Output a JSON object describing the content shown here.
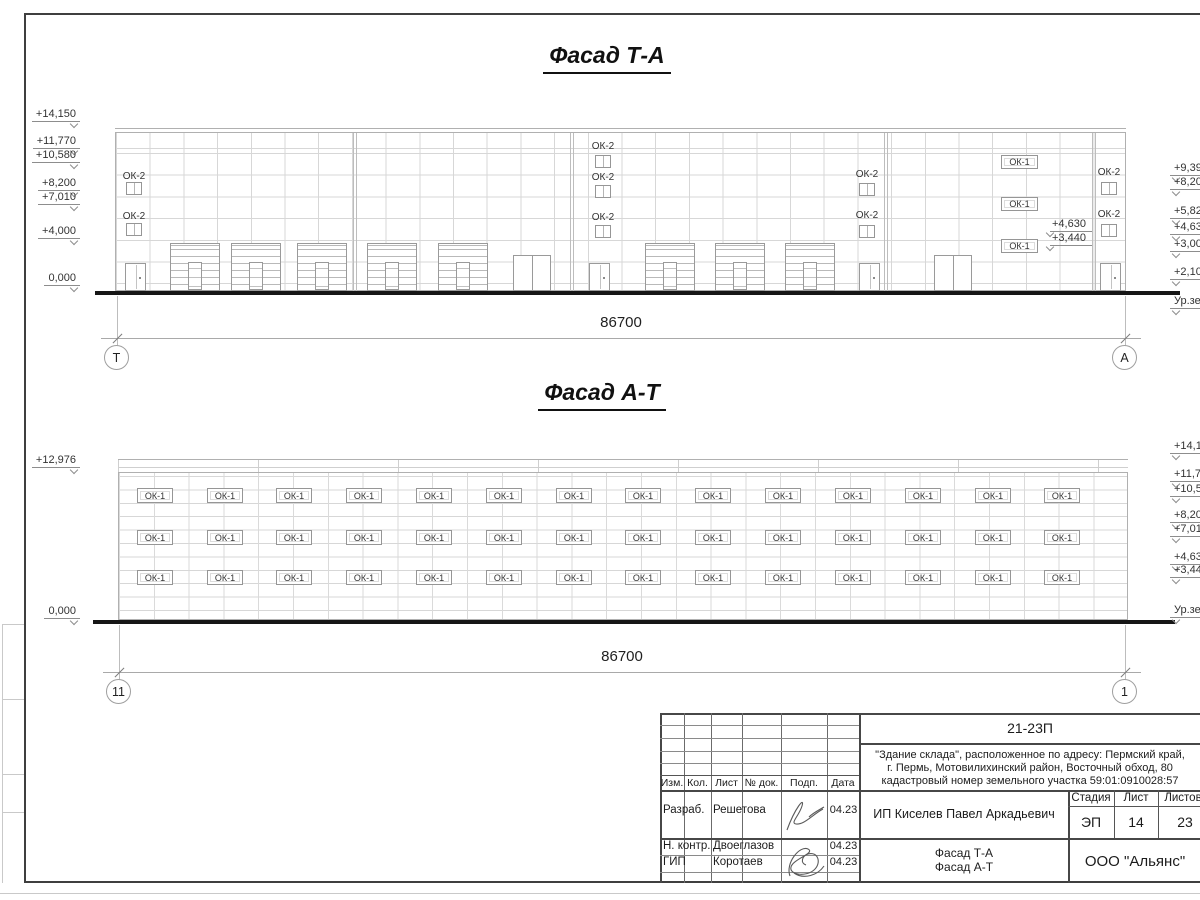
{
  "facade1": {
    "title": "Фасад Т-А",
    "dimension": "86700",
    "axis_left": "Т",
    "axis_right": "А",
    "ok2_label": "ОК-2",
    "ok1_label": "ОК-1",
    "left_marks": [
      {
        "t": "+14,150",
        "y": 115
      },
      {
        "t": "+11,770",
        "y": 142
      },
      {
        "t": "+10,580",
        "y": 156
      },
      {
        "t": "+8,200",
        "y": 184
      },
      {
        "t": "+7,010",
        "y": 198
      },
      {
        "t": "+4,000",
        "y": 232
      },
      {
        "t": "0,000",
        "y": 279
      }
    ],
    "right_marks": [
      {
        "t": "+9,39",
        "y": 169
      },
      {
        "t": "+8,20",
        "y": 183
      },
      {
        "t": "+5,82",
        "y": 212
      },
      {
        "t": "+4,63",
        "y": 228
      },
      {
        "t": "+3,000",
        "y": 245
      },
      {
        "t": "+2,10",
        "y": 273
      },
      {
        "t": "Ур.зе",
        "y": 302
      }
    ],
    "ok2_windows": [
      {
        "x": 126,
        "label_y": 177,
        "win_y": 182
      },
      {
        "x": 126,
        "label_y": 217,
        "win_y": 223
      },
      {
        "x": 595,
        "label_y": 147,
        "win_y": 155
      },
      {
        "x": 595,
        "label_y": 178,
        "win_y": 185
      },
      {
        "x": 595,
        "label_y": 218,
        "win_y": 225
      },
      {
        "x": 859,
        "label_y": 175,
        "win_y": 183
      },
      {
        "x": 859,
        "label_y": 216,
        "win_y": 225
      },
      {
        "x": 1101,
        "label_y": 173,
        "win_y": 182
      },
      {
        "x": 1101,
        "label_y": 215,
        "win_y": 224
      }
    ],
    "ok1_windows": [
      {
        "x": 1001,
        "y": 155
      },
      {
        "x": 1001,
        "y": 197
      },
      {
        "x": 1001,
        "y": 239
      }
    ],
    "annotations": [
      {
        "t": "+4,630",
        "x": 1050,
        "y": 218
      },
      {
        "t": "+3,440",
        "x": 1050,
        "y": 232
      }
    ],
    "doors": [
      125,
      589,
      859,
      1100
    ],
    "double_doors": [
      513,
      934
    ],
    "garage_doors": [
      170,
      231,
      297,
      367,
      438,
      645,
      715,
      785
    ]
  },
  "facade2": {
    "title": "Фасад А-Т",
    "dimension": "86700",
    "axis_left": "11",
    "axis_right": "1",
    "window_label": "ОК-1",
    "window_rows": [
      488,
      530,
      570
    ],
    "window_cols": [
      137,
      207,
      276,
      346,
      416,
      486,
      556,
      625,
      695,
      765,
      835,
      905,
      975,
      1044
    ],
    "left_marks": [
      {
        "t": "+12,976",
        "y": 461
      },
      {
        "t": "0,000",
        "y": 612
      }
    ],
    "right_marks": [
      {
        "t": "+14,15",
        "y": 447
      },
      {
        "t": "+11,77",
        "y": 475
      },
      {
        "t": "+10,58",
        "y": 490
      },
      {
        "t": "+8,20",
        "y": 516
      },
      {
        "t": "+7,01",
        "y": 530
      },
      {
        "t": "+4,63",
        "y": 558
      },
      {
        "t": "+3,44",
        "y": 571
      },
      {
        "t": "Ур.зем",
        "y": 611
      }
    ]
  },
  "titleblock": {
    "doc_number": "21-23П",
    "address_line1": "\"Здание склада\", расположенное по адресу: Пермский край,",
    "address_line2": "г. Пермь, Мотовилихинский район, Восточный обход, 80",
    "address_line3": "кадастровый номер земельного участка 59:01:0910028:57",
    "client": "ИП Киселев Павел Аркадьевич",
    "stage_label": "Стадия",
    "sheet_label": "Лист",
    "sheets_label": "Листов",
    "stage": "ЭП",
    "sheet": "14",
    "sheets": "23",
    "drawing_name_line1": "Фасад Т-А",
    "drawing_name_line2": "Фасад А-Т",
    "company": "ООО \"Альянс\"",
    "header_cols": [
      "Изм.",
      "Кол.",
      "Лист",
      "№ док.",
      "Подп.",
      "Дата"
    ],
    "roles": [
      {
        "role": "Разраб.",
        "name": "Решетова",
        "date": "04.23"
      },
      {
        "role": "Н. контр.",
        "name": "Двоеглазов",
        "date": "04.23"
      },
      {
        "role": "ГИП",
        "name": "Коротаев",
        "date": "04.23"
      }
    ]
  }
}
